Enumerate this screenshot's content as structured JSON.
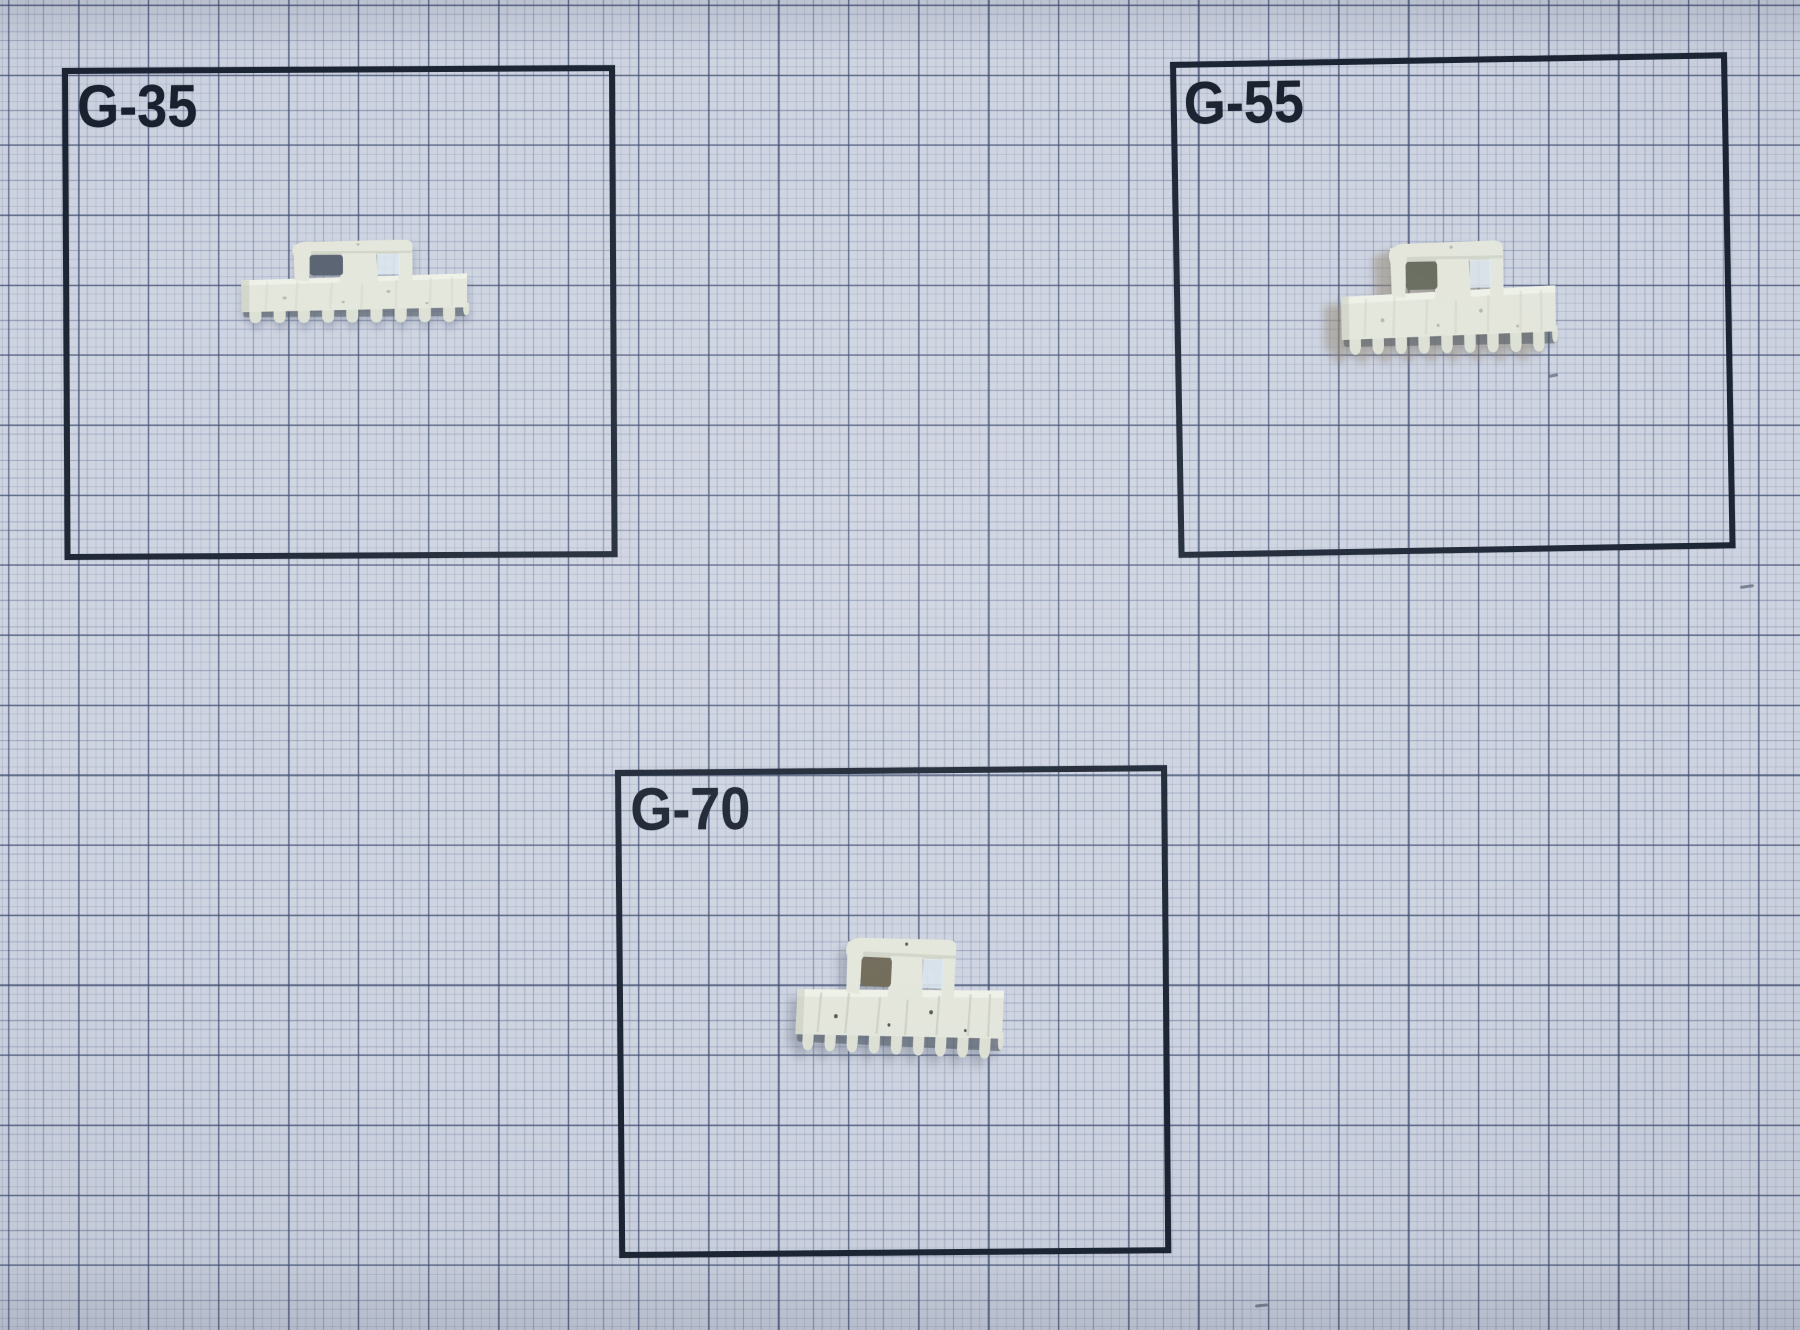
{
  "boxes": [
    {
      "id": "g35",
      "label": "G-35",
      "part_icon": "serrated-comb-part-icon"
    },
    {
      "id": "g55",
      "label": "G-55",
      "part_icon": "serrated-comb-part-icon"
    },
    {
      "id": "g70",
      "label": "G-70",
      "part_icon": "serrated-comb-part-icon"
    }
  ],
  "colors": {
    "paper": "#cdd3e0",
    "grid_fine": "rgba(128,140,170,0.35)",
    "grid_medium": "rgba(98,110,142,0.42)",
    "grid_major": "rgba(58,72,108,0.60)",
    "box_border": "#1b2433",
    "label_text": "#19212f",
    "part_base": "#e3e6db",
    "part_teeth": "#dce0d4",
    "part_highlight": "#f2f4eb",
    "part_shade": "#c2c6b9",
    "part_web": "rgba(226,236,244,0.85)",
    "tooth_gap": "rgba(75,83,92,0.55)",
    "slot_g35": "#58616f",
    "slot_g55": "#686c5e",
    "slot_g70": "#6f6a58"
  }
}
